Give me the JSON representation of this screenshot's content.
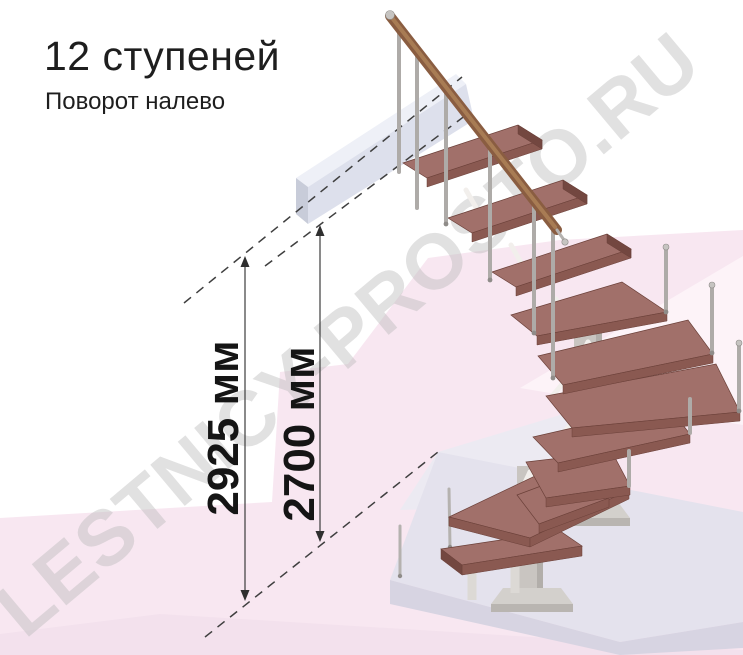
{
  "header": {
    "title": "12 ступеней",
    "subtitle": "Поворот налево"
  },
  "dimensions": {
    "overall_height": "2925 мм",
    "floor_height": "2700 мм"
  },
  "watermark": {
    "text": "LESTNICY-PROSTO.RU"
  },
  "staircase": {
    "steps": 12,
    "turn": "Поворот налево",
    "colors": {
      "tread_top": "#a1706a",
      "tread_front": "#8a5951",
      "tread_side": "#734740",
      "handrail": "#8a5d41",
      "metal_baluster": "#aeaba8",
      "column": "#c9c5c1",
      "upper_platform": "#dde0ec",
      "base_slab": "#e4e2ed",
      "floor_pink": "#f8e7f1",
      "dimension_ink": "#2f2f2f",
      "watermark_gray": "#bdbdbd"
    }
  }
}
